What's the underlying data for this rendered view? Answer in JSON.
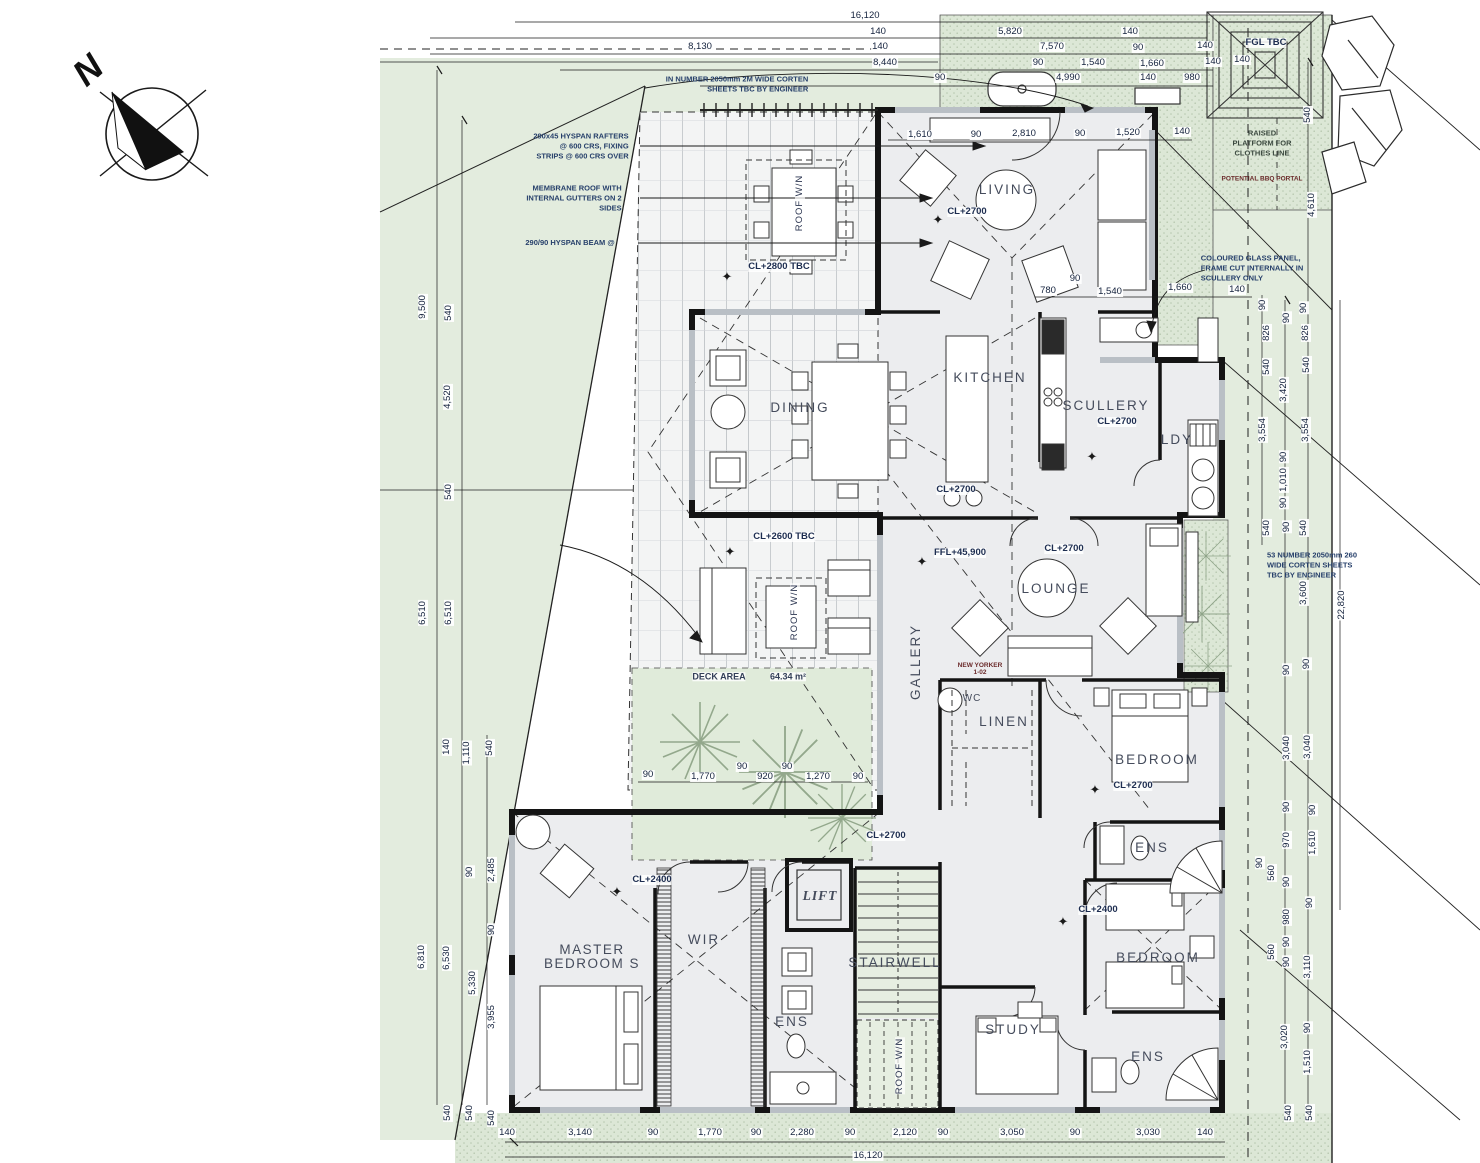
{
  "drawing": {
    "kind": "architectural floor plan",
    "north_arrow": "N"
  },
  "colors": {
    "site_green": "#e3ecde",
    "stipple_green": "#dce7d6",
    "floor": "#ecedef",
    "wall": "#141414",
    "dim_text": "#14223d",
    "room_text": "#454c5c"
  },
  "labels": [
    {
      "t": "N",
      "x": 88,
      "y": 70,
      "r": -42,
      "c": "north",
      "n": "north-label"
    },
    {
      "t": "LIVING",
      "x": 1007,
      "y": 190,
      "c": "room",
      "n": "room-label-living"
    },
    {
      "t": "KITCHEN",
      "x": 990,
      "y": 378,
      "c": "room",
      "n": "room-label-kitchen"
    },
    {
      "t": "DINING",
      "x": 800,
      "y": 408,
      "c": "room",
      "n": "room-label-dining"
    },
    {
      "t": "SCULLERY",
      "x": 1106,
      "y": 406,
      "c": "room",
      "n": "room-label-scullery"
    },
    {
      "t": "LDY",
      "x": 1177,
      "y": 440,
      "c": "room",
      "n": "room-label-ldy"
    },
    {
      "t": "LOUNGE",
      "x": 1056,
      "y": 589,
      "c": "room",
      "n": "room-label-lounge"
    },
    {
      "t": "GALLERY",
      "x": 916,
      "y": 662,
      "r": -90,
      "c": "room",
      "n": "room-label-gallery"
    },
    {
      "t": "LINEN",
      "x": 1004,
      "y": 722,
      "c": "room",
      "n": "room-label-linen"
    },
    {
      "t": "WC",
      "x": 972,
      "y": 699,
      "c": "room sm",
      "n": "room-label-wc"
    },
    {
      "t": "BEDROOM",
      "x": 1157,
      "y": 760,
      "c": "room",
      "n": "room-label-bedroom-1"
    },
    {
      "t": "ENS",
      "x": 1152,
      "y": 848,
      "c": "room",
      "n": "room-label-ens-1"
    },
    {
      "t": "MASTER\nBEDROOM S",
      "x": 592,
      "y": 957,
      "c": "room center",
      "n": "room-label-master-bedroom"
    },
    {
      "t": "WIR",
      "x": 704,
      "y": 940,
      "c": "room",
      "n": "room-label-wir"
    },
    {
      "t": "LIFT",
      "x": 820,
      "y": 896,
      "c": "room italic",
      "n": "room-label-lift"
    },
    {
      "t": "STAIRWELL",
      "x": 895,
      "y": 963,
      "c": "room",
      "n": "room-label-stairwell"
    },
    {
      "t": "ENS",
      "x": 792,
      "y": 1022,
      "c": "room",
      "n": "room-label-ens-master"
    },
    {
      "t": "STUDY",
      "x": 1013,
      "y": 1030,
      "c": "room",
      "n": "room-label-study"
    },
    {
      "t": "BEDROOM",
      "x": 1158,
      "y": 958,
      "c": "room",
      "n": "room-label-bedroom-2"
    },
    {
      "t": "ENS",
      "x": 1148,
      "y": 1057,
      "c": "room",
      "n": "room-label-ens-2"
    },
    {
      "t": "CL+2700",
      "x": 967,
      "y": 212,
      "c": "lvl"
    },
    {
      "t": "CL+2800 TBC",
      "x": 779,
      "y": 267,
      "c": "lvl"
    },
    {
      "t": "CL+2700",
      "x": 1117,
      "y": 422,
      "c": "lvl"
    },
    {
      "t": "CL+2700",
      "x": 956,
      "y": 490,
      "c": "lvl"
    },
    {
      "t": "CL+2600 TBC",
      "x": 784,
      "y": 537,
      "c": "lvl"
    },
    {
      "t": "FFL+45,900",
      "x": 960,
      "y": 553,
      "c": "lvl"
    },
    {
      "t": "CL+2700",
      "x": 1064,
      "y": 549,
      "c": "lvl"
    },
    {
      "t": "CL+2700",
      "x": 1133,
      "y": 786,
      "c": "lvl"
    },
    {
      "t": "CL+2700",
      "x": 886,
      "y": 836,
      "c": "lvl"
    },
    {
      "t": "CL+2400",
      "x": 652,
      "y": 880,
      "c": "lvl"
    },
    {
      "t": "CL+2400",
      "x": 1098,
      "y": 910,
      "c": "lvl"
    },
    {
      "t": "FGL TBC",
      "x": 1266,
      "y": 43,
      "c": "lvl",
      "n": "note-fgl-tbc"
    },
    {
      "t": "✦",
      "x": 938,
      "y": 220,
      "c": "star",
      "n": "star-symbol"
    },
    {
      "t": "✦",
      "x": 727,
      "y": 277,
      "c": "star",
      "n": "star-symbol"
    },
    {
      "t": "✦",
      "x": 1092,
      "y": 457,
      "c": "star",
      "n": "star-symbol"
    },
    {
      "t": "✦",
      "x": 730,
      "y": 552,
      "c": "star",
      "n": "star-symbol"
    },
    {
      "t": "✦",
      "x": 922,
      "y": 562,
      "c": "star",
      "n": "star-symbol"
    },
    {
      "t": "✦",
      "x": 1095,
      "y": 790,
      "c": "star",
      "n": "star-symbol"
    },
    {
      "t": "✦",
      "x": 617,
      "y": 892,
      "c": "star",
      "n": "star-symbol"
    },
    {
      "t": "✦",
      "x": 1063,
      "y": 922,
      "c": "star",
      "n": "star-symbol"
    },
    {
      "t": "IN NUMBER 2050mm 2M WIDE CORTEN\nSHEETS TBC BY ENGINEER",
      "x": 737,
      "y": 84,
      "c": "note",
      "n": "note-corten-sheets-top"
    },
    {
      "t": "290x45 HYSPAN RAFTERS\n@ 600 CRS, FIXING\nSTRIPS @ 600 CRS OVER",
      "x": 581,
      "y": 146,
      "c": "note",
      "n": "note-rafters"
    },
    {
      "t": "MEMBRANE ROOF WITH\nINTERNAL GUTTERS ON 2\nSIDES",
      "x": 574,
      "y": 198,
      "c": "note",
      "n": "note-membrane-roof"
    },
    {
      "t": "290/90 HYSPAN BEAM @",
      "x": 570,
      "y": 243,
      "c": "note",
      "n": "note-hyspan-beam"
    },
    {
      "t": "RAISED\nPLATFORM FOR\nCLOTHES LINE",
      "x": 1262,
      "y": 143,
      "c": "note center",
      "n": "note-clothes-line"
    },
    {
      "t": "POTENTIAL BBQ PORTAL",
      "x": 1262,
      "y": 180,
      "c": "tiny",
      "n": "note-potential-portal"
    },
    {
      "t": "COLOURED GLASS PANEL,\nFRAME CUT INTERNALLY IN\nSCULLERY ONLY",
      "x": 1252,
      "y": 268,
      "c": "note left",
      "n": "note-coloured-glass"
    },
    {
      "t": "53 NUMBER 2050mm 260\nWIDE CORTEN SHEETS\nTBC BY ENGINEER",
      "x": 1312,
      "y": 565,
      "c": "note left",
      "n": "note-corten-sheets-right"
    },
    {
      "t": "NEW YORKER\n1-02",
      "x": 980,
      "y": 670,
      "c": "tiny",
      "n": "note-new-yorker"
    },
    {
      "t": "DECK AREA",
      "x": 719,
      "y": 677,
      "c": "deck",
      "n": "deck-area-label"
    },
    {
      "t": "64.34 m²",
      "x": 788,
      "y": 677,
      "c": "deck",
      "n": "deck-area-value"
    },
    {
      "t": "ROOF W/N",
      "x": 800,
      "y": 203,
      "r": -90,
      "c": "roofwn",
      "n": "roof-window-label"
    },
    {
      "t": "ROOF W/N",
      "x": 795,
      "y": 612,
      "r": -90,
      "c": "roofwn",
      "n": "roof-window-label"
    },
    {
      "t": "ROOF W/N",
      "x": 900,
      "y": 1066,
      "r": -90,
      "c": "roofwn",
      "n": "roof-window-label"
    },
    {
      "t": "16,120",
      "x": 865,
      "y": 16
    },
    {
      "t": "140",
      "x": 878,
      "y": 32
    },
    {
      "t": "5,820",
      "x": 1010,
      "y": 32
    },
    {
      "t": "140",
      "x": 1130,
      "y": 32
    },
    {
      "t": "8,130",
      "x": 700,
      "y": 47
    },
    {
      "t": "140",
      "x": 880,
      "y": 47
    },
    {
      "t": "7,570",
      "x": 1052,
      "y": 47
    },
    {
      "t": "90",
      "x": 1138,
      "y": 48
    },
    {
      "t": "140",
      "x": 1205,
      "y": 46
    },
    {
      "t": "8,440",
      "x": 885,
      "y": 63
    },
    {
      "t": "90",
      "x": 1038,
      "y": 63
    },
    {
      "t": "1,540",
      "x": 1093,
      "y": 63
    },
    {
      "t": "1,660",
      "x": 1152,
      "y": 64
    },
    {
      "t": "140",
      "x": 1213,
      "y": 62
    },
    {
      "t": "90",
      "x": 940,
      "y": 78
    },
    {
      "t": "4,990",
      "x": 1068,
      "y": 78
    },
    {
      "t": "140",
      "x": 1148,
      "y": 78
    },
    {
      "t": "980",
      "x": 1192,
      "y": 78
    },
    {
      "t": "140",
      "x": 1242,
      "y": 60
    },
    {
      "t": "540",
      "x": 1308,
      "y": 115,
      "r": -90
    },
    {
      "t": "4,610",
      "x": 1312,
      "y": 205,
      "r": -90
    },
    {
      "t": "1,610",
      "x": 920,
      "y": 135
    },
    {
      "t": "90",
      "x": 976,
      "y": 135
    },
    {
      "t": "2,810",
      "x": 1024,
      "y": 134
    },
    {
      "t": "90",
      "x": 1080,
      "y": 134
    },
    {
      "t": "1,520",
      "x": 1128,
      "y": 133
    },
    {
      "t": "140",
      "x": 1182,
      "y": 132
    },
    {
      "t": "90",
      "x": 1075,
      "y": 279
    },
    {
      "t": "780",
      "x": 1048,
      "y": 291
    },
    {
      "t": "1,540",
      "x": 1110,
      "y": 292
    },
    {
      "t": "1,660",
      "x": 1180,
      "y": 288
    },
    {
      "t": "140",
      "x": 1237,
      "y": 290
    },
    {
      "t": "90",
      "x": 648,
      "y": 775
    },
    {
      "t": "1,770",
      "x": 703,
      "y": 777
    },
    {
      "t": "90",
      "x": 742,
      "y": 767
    },
    {
      "t": "920",
      "x": 765,
      "y": 777
    },
    {
      "t": "90",
      "x": 787,
      "y": 767
    },
    {
      "t": "1,270",
      "x": 818,
      "y": 777
    },
    {
      "t": "90",
      "x": 858,
      "y": 777
    },
    {
      "t": "9,500",
      "x": 423,
      "y": 307,
      "r": -90
    },
    {
      "t": "540",
      "x": 449,
      "y": 313,
      "r": -90
    },
    {
      "t": "4,520",
      "x": 448,
      "y": 397,
      "r": -90
    },
    {
      "t": "540",
      "x": 449,
      "y": 492,
      "r": -90
    },
    {
      "t": "6,510",
      "x": 423,
      "y": 613,
      "r": -90
    },
    {
      "t": "6,510",
      "x": 449,
      "y": 613,
      "r": -90
    },
    {
      "t": "140",
      "x": 447,
      "y": 747,
      "r": -90
    },
    {
      "t": "1,110",
      "x": 467,
      "y": 753,
      "r": -90
    },
    {
      "t": "540",
      "x": 490,
      "y": 748,
      "r": -90
    },
    {
      "t": "90",
      "x": 470,
      "y": 872,
      "r": -90
    },
    {
      "t": "2,485",
      "x": 492,
      "y": 870,
      "r": -90
    },
    {
      "t": "90",
      "x": 492,
      "y": 930,
      "r": -90
    },
    {
      "t": "6,810",
      "x": 422,
      "y": 957,
      "r": -90
    },
    {
      "t": "6,530",
      "x": 447,
      "y": 958,
      "r": -90
    },
    {
      "t": "5,330",
      "x": 473,
      "y": 983,
      "r": -90
    },
    {
      "t": "3,955",
      "x": 492,
      "y": 1017,
      "r": -90
    },
    {
      "t": "540",
      "x": 448,
      "y": 1113,
      "r": -90
    },
    {
      "t": "540",
      "x": 470,
      "y": 1113,
      "r": -90
    },
    {
      "t": "540",
      "x": 492,
      "y": 1118,
      "r": -90
    },
    {
      "t": "140",
      "x": 507,
      "y": 1133
    },
    {
      "t": "3,140",
      "x": 580,
      "y": 1133
    },
    {
      "t": "90",
      "x": 653,
      "y": 1133
    },
    {
      "t": "1,770",
      "x": 710,
      "y": 1133
    },
    {
      "t": "90",
      "x": 756,
      "y": 1133
    },
    {
      "t": "2,280",
      "x": 802,
      "y": 1133
    },
    {
      "t": "90",
      "x": 850,
      "y": 1133
    },
    {
      "t": "2,120",
      "x": 905,
      "y": 1133
    },
    {
      "t": "90",
      "x": 943,
      "y": 1133
    },
    {
      "t": "3,050",
      "x": 1012,
      "y": 1133
    },
    {
      "t": "90",
      "x": 1075,
      "y": 1133
    },
    {
      "t": "3,030",
      "x": 1148,
      "y": 1133
    },
    {
      "t": "140",
      "x": 1205,
      "y": 1133
    },
    {
      "t": "16,120",
      "x": 868,
      "y": 1156
    },
    {
      "t": "90",
      "x": 1263,
      "y": 305,
      "r": -90
    },
    {
      "t": "90",
      "x": 1304,
      "y": 308,
      "r": -90
    },
    {
      "t": "90",
      "x": 1287,
      "y": 318,
      "r": -90
    },
    {
      "t": "826",
      "x": 1267,
      "y": 333,
      "r": -90
    },
    {
      "t": "826",
      "x": 1306,
      "y": 333,
      "r": -90
    },
    {
      "t": "540",
      "x": 1267,
      "y": 367,
      "r": -90
    },
    {
      "t": "540",
      "x": 1307,
      "y": 365,
      "r": -90
    },
    {
      "t": "3,420",
      "x": 1284,
      "y": 390,
      "r": -90
    },
    {
      "t": "3,554",
      "x": 1263,
      "y": 430,
      "r": -90
    },
    {
      "t": "3,554",
      "x": 1306,
      "y": 430,
      "r": -90
    },
    {
      "t": "90",
      "x": 1284,
      "y": 457,
      "r": -90
    },
    {
      "t": "1,010",
      "x": 1284,
      "y": 480,
      "r": -90
    },
    {
      "t": "90",
      "x": 1284,
      "y": 503,
      "r": -90
    },
    {
      "t": "540",
      "x": 1267,
      "y": 528,
      "r": -90
    },
    {
      "t": "90",
      "x": 1287,
      "y": 527,
      "r": -90
    },
    {
      "t": "540",
      "x": 1304,
      "y": 528,
      "r": -90
    },
    {
      "t": "3,600",
      "x": 1304,
      "y": 593,
      "r": -90
    },
    {
      "t": "22,820",
      "x": 1342,
      "y": 605,
      "r": -90
    },
    {
      "t": "90",
      "x": 1287,
      "y": 670,
      "r": -90
    },
    {
      "t": "90",
      "x": 1307,
      "y": 664,
      "r": -90
    },
    {
      "t": "3,040",
      "x": 1287,
      "y": 748,
      "r": -90
    },
    {
      "t": "3,040",
      "x": 1308,
      "y": 747,
      "r": -90
    },
    {
      "t": "90",
      "x": 1287,
      "y": 807,
      "r": -90
    },
    {
      "t": "90",
      "x": 1313,
      "y": 810,
      "r": -90
    },
    {
      "t": "970",
      "x": 1287,
      "y": 840,
      "r": -90
    },
    {
      "t": "1,610",
      "x": 1313,
      "y": 843,
      "r": -90
    },
    {
      "t": "90",
      "x": 1260,
      "y": 863,
      "r": -90
    },
    {
      "t": "560",
      "x": 1272,
      "y": 873,
      "r": -90
    },
    {
      "t": "90",
      "x": 1287,
      "y": 882,
      "r": -90
    },
    {
      "t": "90",
      "x": 1310,
      "y": 903,
      "r": -90
    },
    {
      "t": "980",
      "x": 1287,
      "y": 917,
      "r": -90
    },
    {
      "t": "90",
      "x": 1287,
      "y": 942,
      "r": -90
    },
    {
      "t": "560",
      "x": 1272,
      "y": 952,
      "r": -90
    },
    {
      "t": "90",
      "x": 1287,
      "y": 962,
      "r": -90
    },
    {
      "t": "3,110",
      "x": 1308,
      "y": 967,
      "r": -90
    },
    {
      "t": "90",
      "x": 1308,
      "y": 1028,
      "r": -90
    },
    {
      "t": "3,020",
      "x": 1285,
      "y": 1037,
      "r": -90
    },
    {
      "t": "1,510",
      "x": 1308,
      "y": 1062,
      "r": -90
    },
    {
      "t": "540",
      "x": 1289,
      "y": 1113,
      "r": -90
    },
    {
      "t": "540",
      "x": 1310,
      "y": 1113,
      "r": -90
    }
  ]
}
